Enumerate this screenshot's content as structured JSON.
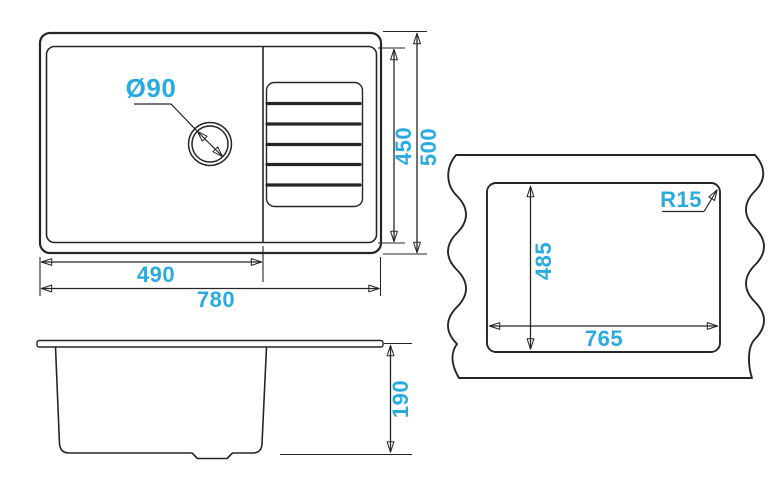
{
  "colors": {
    "accent": "#29ABE2",
    "line": "#262626",
    "background": "#FFFFFF"
  },
  "top_view": {
    "drain_diameter": "Ø90",
    "bowl_width": "490",
    "overall_width": "780",
    "inner_depth": "450",
    "overall_depth": "500"
  },
  "front_view": {
    "bowl_height": "190"
  },
  "cutout_view": {
    "cutout_width": "765",
    "cutout_depth": "485",
    "corner_radius": "R15"
  }
}
